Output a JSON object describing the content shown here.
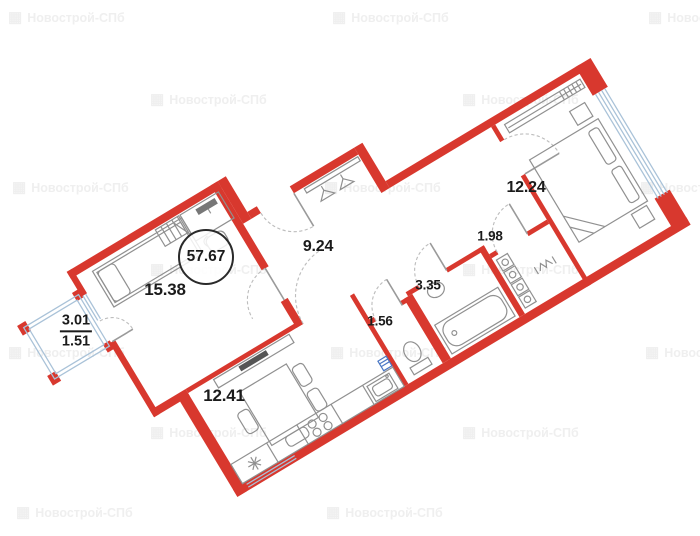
{
  "watermark": {
    "text": "Новострой-СПб"
  },
  "plan": {
    "total_area": "57.67",
    "rooms": [
      {
        "id": "living-room",
        "area": "15.38"
      },
      {
        "id": "hallway",
        "area": "9.24"
      },
      {
        "id": "kitchen-living",
        "area": "12.41"
      },
      {
        "id": "bedroom",
        "area": "12.24"
      },
      {
        "id": "storage",
        "area": "1.98"
      },
      {
        "id": "bathroom",
        "area": "3.35"
      },
      {
        "id": "wc",
        "area": "1.56"
      }
    ],
    "balcony": {
      "area_full": "3.01",
      "area_coeff": "1.51"
    },
    "colors": {
      "wall_red": "#d8382e",
      "glazing_blue": "#a9c2d8",
      "fixture_gray": "#909090",
      "watermark_gray": "#efefef"
    }
  }
}
